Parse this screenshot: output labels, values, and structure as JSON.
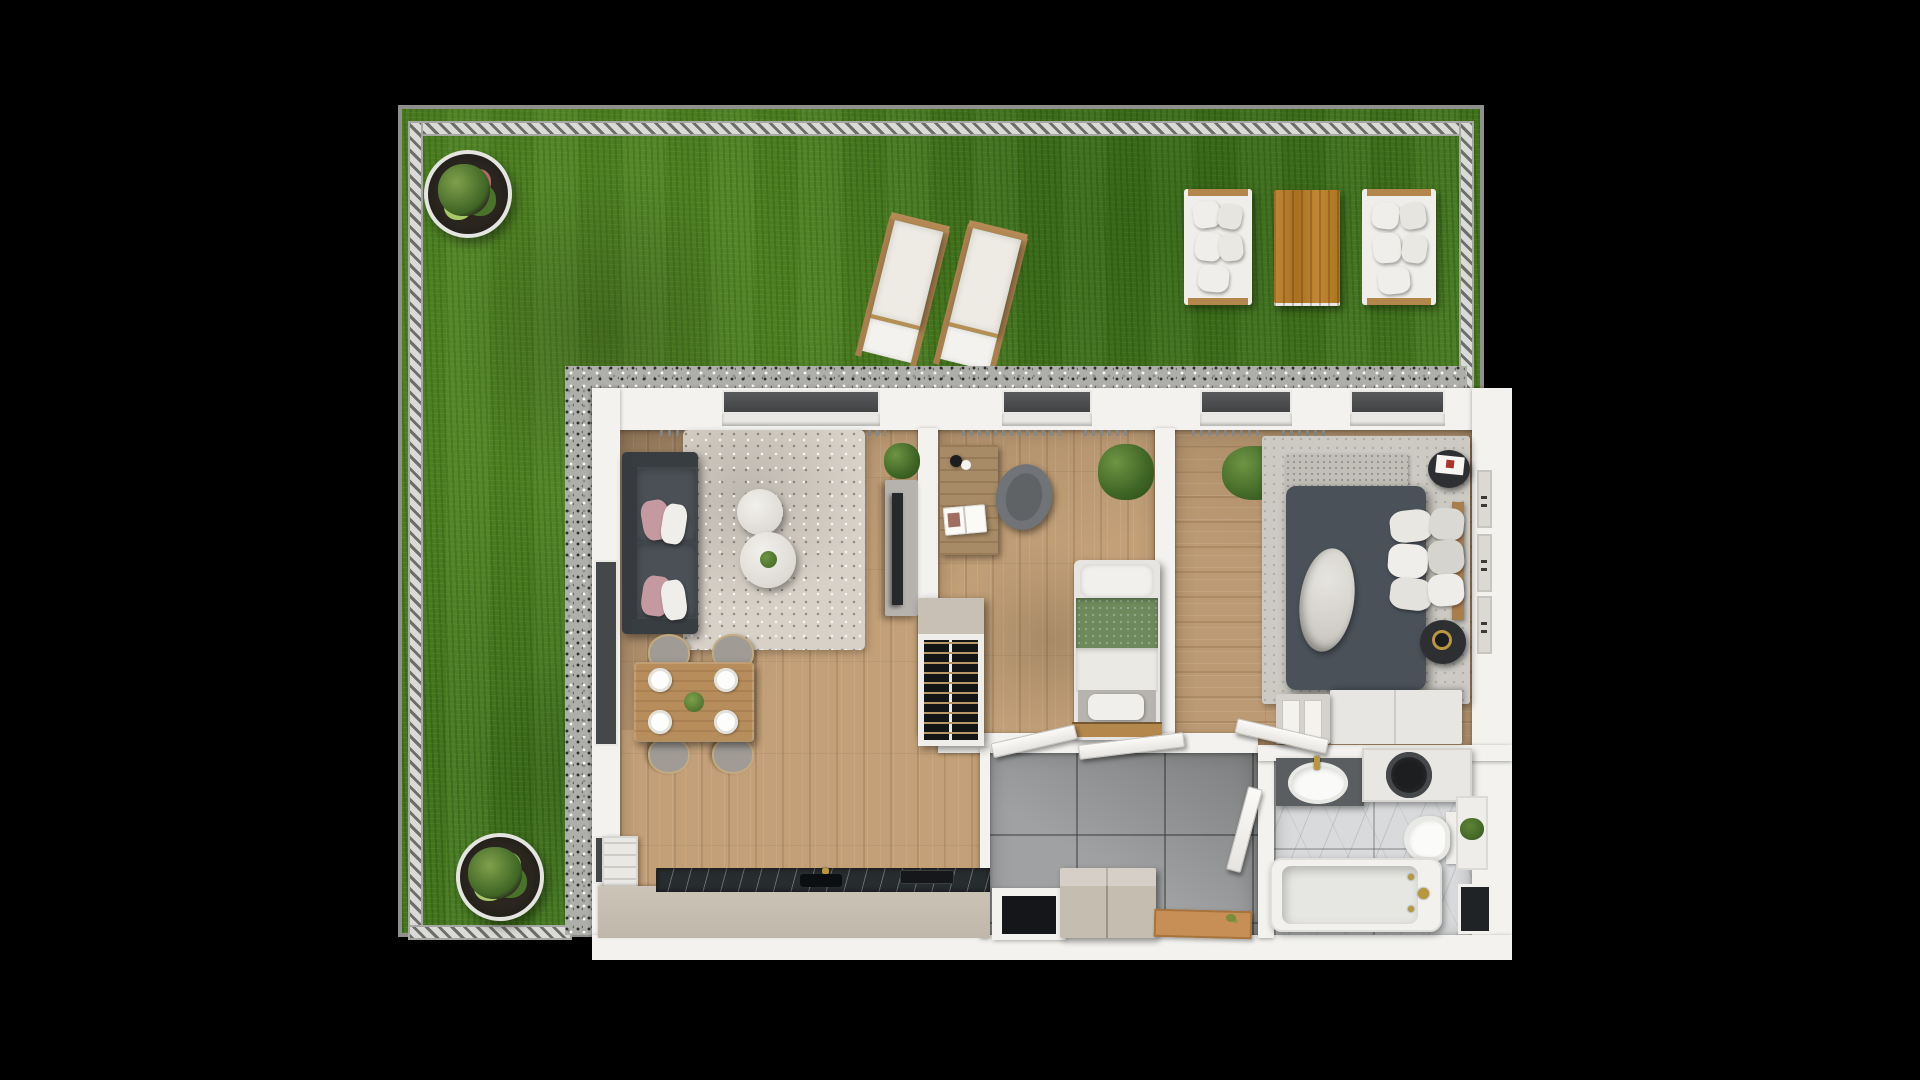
{
  "meta": {
    "title": "Top-down 3D rendered floor plan of a two-bedroom apartment with private garden",
    "canvas": {
      "width": 1920,
      "height": 1080,
      "background": "#000000"
    },
    "view": "top-down architectural visualization, no on-screen text"
  },
  "areas": {
    "garden": "garden",
    "living": "living-room-with-kitchen",
    "child": "child-room",
    "bedroom": "bedroom",
    "hall": "hallway",
    "bath": "bathroom"
  },
  "garden": {
    "ground": "lawn grass",
    "fence": "hatched metal fence on top, left, right and bottom-left edges",
    "items": [
      "round-planter-top-left",
      "round-planter-bottom-left",
      "sun-lounger-1",
      "sun-lounger-2",
      "outdoor-sofa-left",
      "outdoor-coffee-table",
      "outdoor-sofa-right"
    ]
  },
  "apartment": {
    "shell": [
      "gravel-drainage-border",
      "white-perimeter-walls",
      "four-dark-windows-on-top-wall"
    ],
    "rooms": [
      {
        "name": "living-room-with-kitchen",
        "floor": "oak planks",
        "furniture": [
          "dark-gray-sofa-with-pink-and-white-cushions",
          "shaggy-area-rug",
          "round-coffee-table-small",
          "round-coffee-table-large-with-plant",
          "tv-sideboard-with-tv",
          "plant-beside-tv",
          "dining-table-with-four-place-settings-and-plant",
          "four-dining-chairs",
          "kitchen-counter-with-dark-marble-top-sink-and-hob",
          "tall-white-cabinet",
          "open-shoe-wardrobe",
          "floor-to-ceiling-glazing-on-left-wall"
        ]
      },
      {
        "name": "child-room",
        "floor": "oak planks",
        "furniture": [
          "desk-with-lamp-and-open-book",
          "desk-chair",
          "potted-plant",
          "single-bed-with-green-blanket-and-white-pillows",
          "foot-bench"
        ]
      },
      {
        "name": "bedroom",
        "floor": "oak planks",
        "furniture": [
          "double-bed-dark-gray-duvet-white-throw",
          "pillow-group",
          "headboard",
          "round-bedside-table-with-book",
          "round-bedside-table-with-gold-tray",
          "light-rug",
          "potted-plant",
          "long-white-dresser",
          "two-drawer-nightstand",
          "wall-radiator-panels"
        ]
      },
      {
        "name": "hallway",
        "floor": "gray ceramic tiles",
        "furniture": [
          "beige-shoe-cabinet",
          "wooden-doormat",
          "entrance-niche",
          "door-to-living-room",
          "door-to-child-room",
          "door-to-bedroom",
          "door-to-bathroom"
        ]
      },
      {
        "name": "bathroom",
        "floor": "white-gray marble",
        "furniture": [
          "vanity-with-oval-sink-and-gold-faucet",
          "washing-machine",
          "toilet",
          "shelf-with-plant",
          "bathtub-with-gold-fixtures",
          "storage-niche"
        ]
      }
    ]
  },
  "palette": {
    "background": "#000000",
    "grass": "#477a1f",
    "fence_light": "#dadad6",
    "fence_dark": "#6d6d69",
    "gravel": "#aeaeaa",
    "wall_white": "#f3f2ef",
    "window_glass": "#4a4c4e",
    "wood_floor": "#c3a078",
    "tile_gray": "#9fa1a2",
    "marble": "#d8dadb",
    "sofa_charcoal": "#41464b",
    "pillow_pink": "#c49aa0",
    "blanket_green": "#6e8a5c",
    "duvet_gray": "#4a5159",
    "outdoor_table_wood": "#bf8331",
    "counter_beige": "#c5bcb0",
    "countertop_dark": "#272c2f",
    "doormat_wood": "#c78f55",
    "gold_fixture": "#b8973f",
    "plant_green": "#3f6525"
  }
}
